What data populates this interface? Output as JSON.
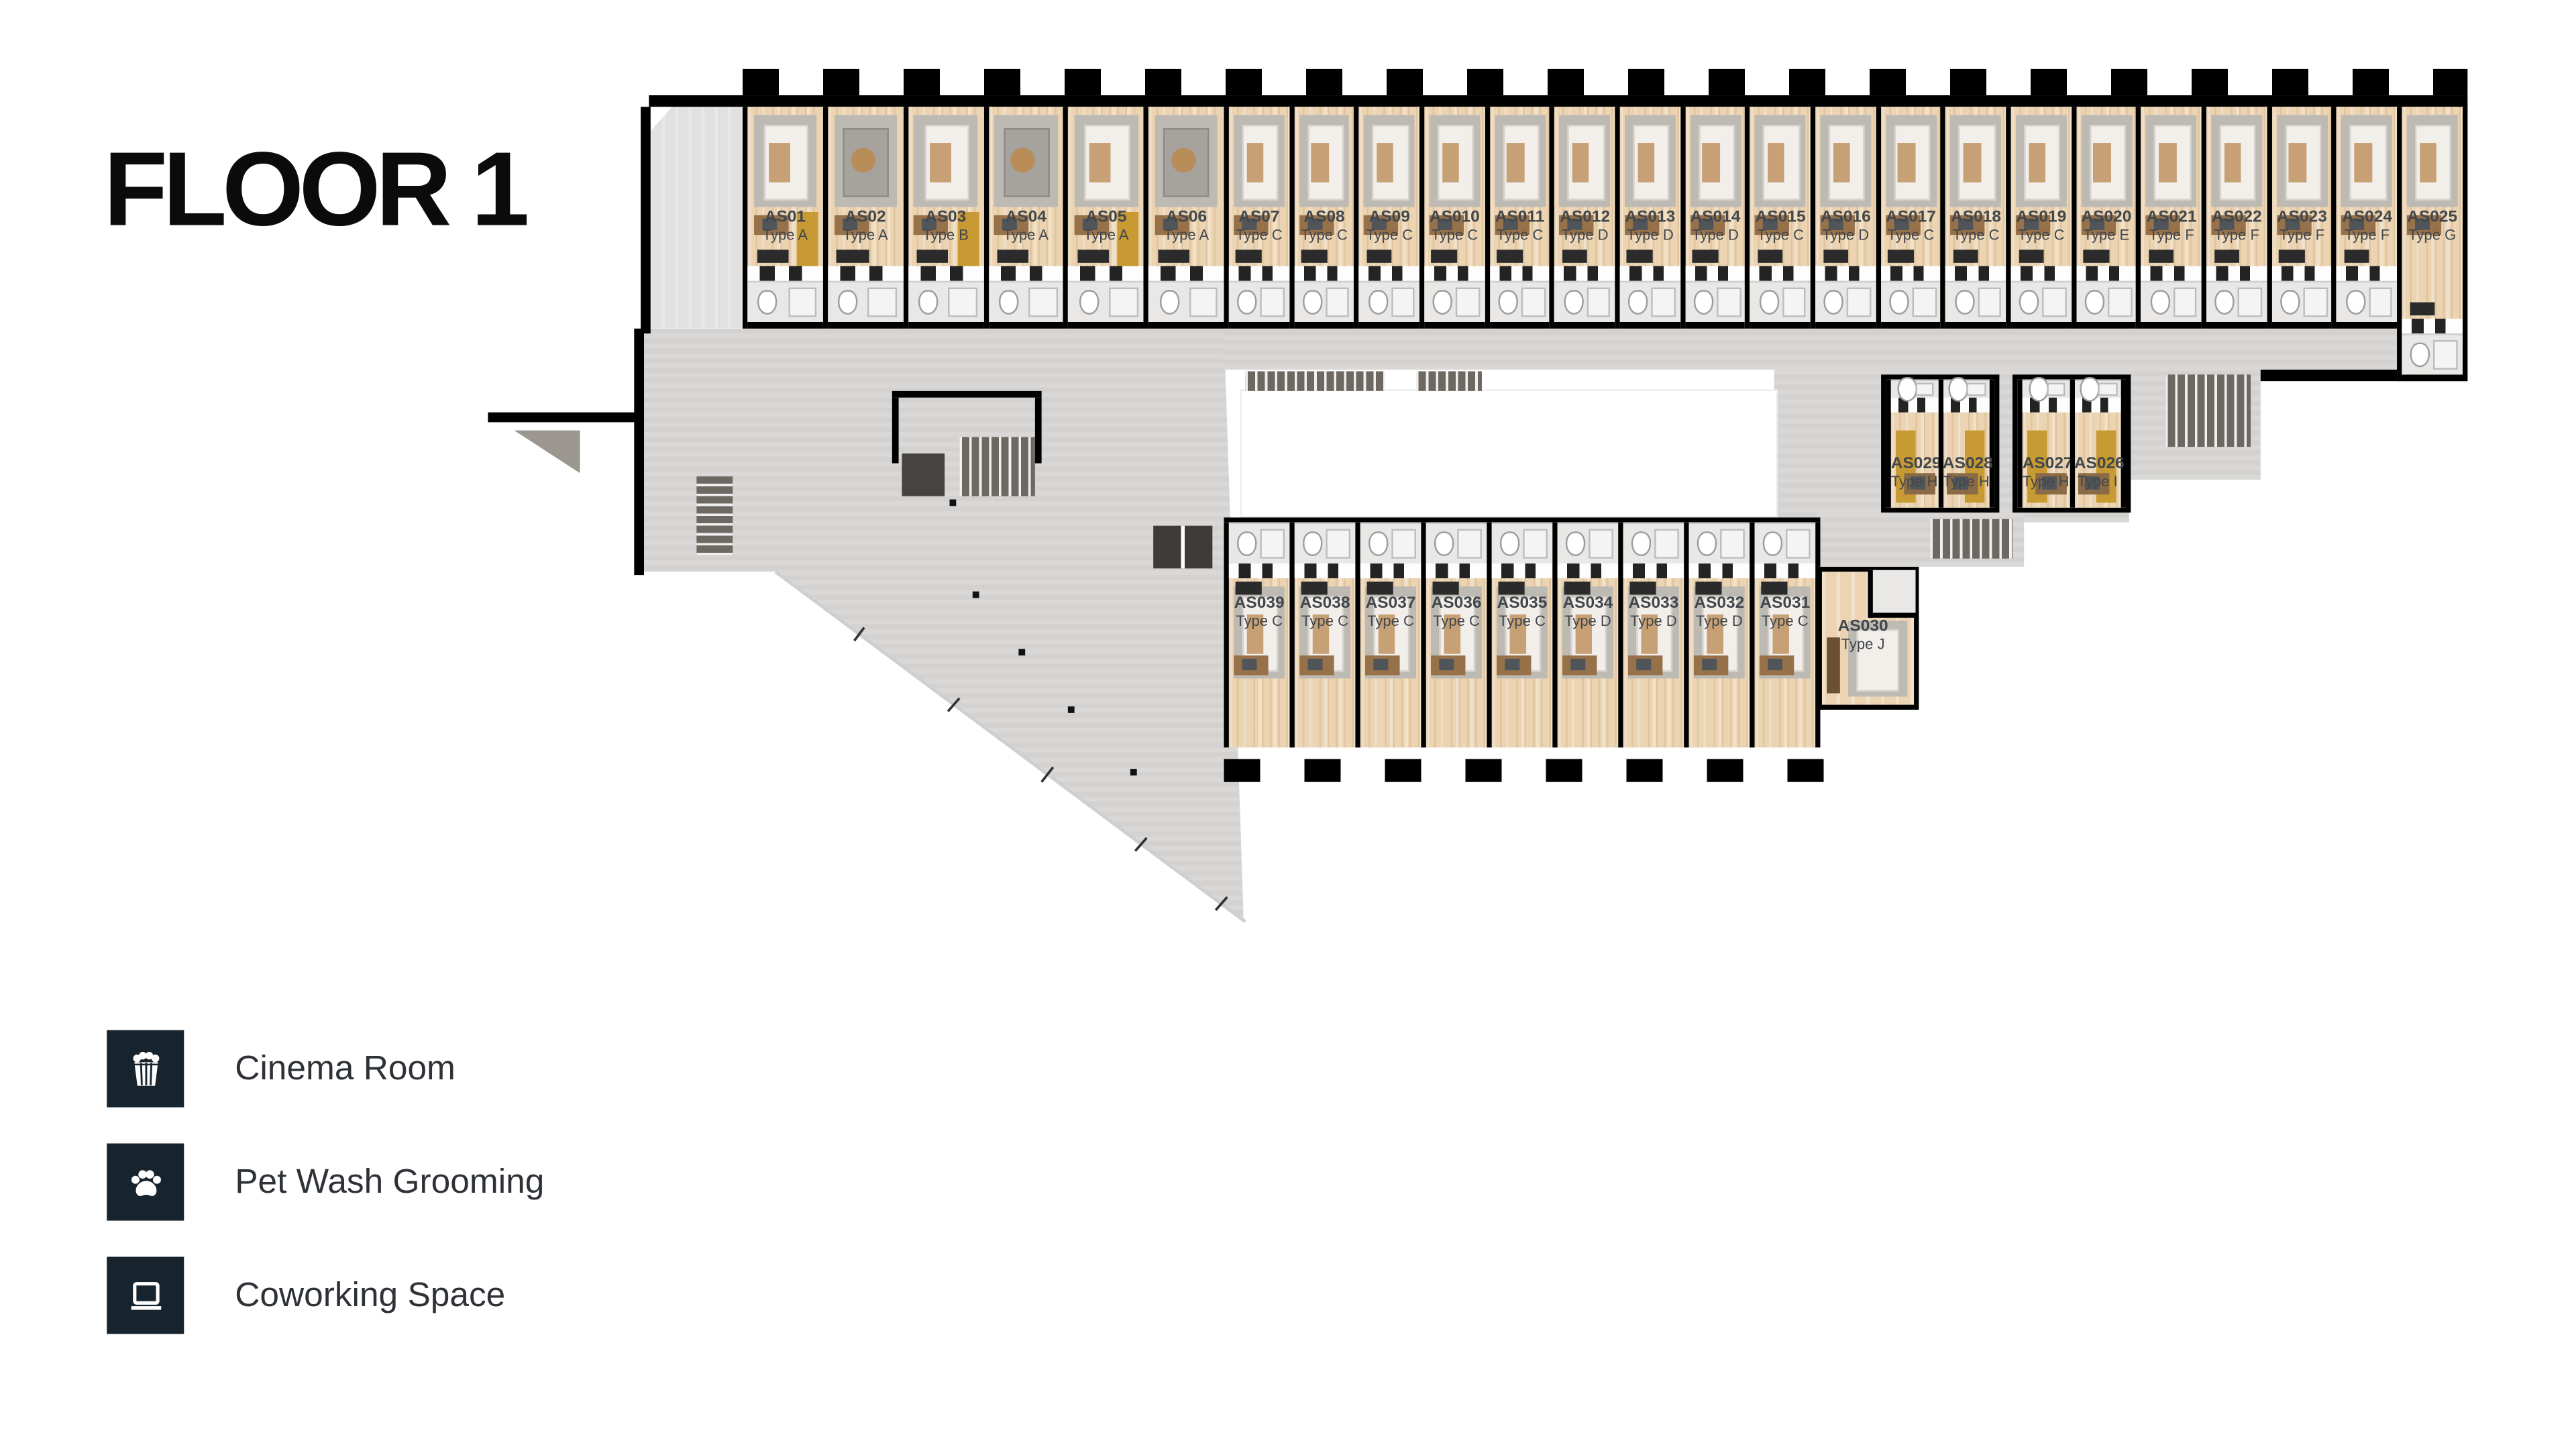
{
  "title": "FLOOR 1",
  "legend": [
    {
      "icon": "popcorn-icon",
      "label": "Cinema Room"
    },
    {
      "icon": "paw-icon",
      "label": "Pet Wash Grooming"
    },
    {
      "icon": "laptop-icon",
      "label": "Coworking Space"
    }
  ],
  "colors": {
    "legend_square": "#17242e",
    "wall": "#000000",
    "common_floor": "#d7d6d5",
    "unit_floor": "#ecd4b2",
    "stair": "#6e6862",
    "accent_sofa": "#c79a33",
    "label_text": "#42474c"
  },
  "plan": {
    "top_row": {
      "units": [
        {
          "id": "AS01",
          "type": "Type A",
          "wide": true,
          "furn": "bed"
        },
        {
          "id": "AS02",
          "type": "Type A",
          "wide": true,
          "furn": "sofa"
        },
        {
          "id": "AS03",
          "type": "Type B",
          "wide": true,
          "furn": "bed"
        },
        {
          "id": "AS04",
          "type": "Type A",
          "wide": true,
          "furn": "sofa"
        },
        {
          "id": "AS05",
          "type": "Type A",
          "wide": true,
          "furn": "bed"
        },
        {
          "id": "AS06",
          "type": "Type A",
          "wide": true,
          "furn": "sofa"
        },
        {
          "id": "AS07",
          "type": "Type C",
          "furn": "bed"
        },
        {
          "id": "AS08",
          "type": "Type C",
          "furn": "bed"
        },
        {
          "id": "AS09",
          "type": "Type C",
          "furn": "bed"
        },
        {
          "id": "AS010",
          "type": "Type C",
          "furn": "bed"
        },
        {
          "id": "AS011",
          "type": "Type C",
          "furn": "bed"
        },
        {
          "id": "AS012",
          "type": "Type D",
          "furn": "bed"
        },
        {
          "id": "AS013",
          "type": "Type D",
          "furn": "bed"
        },
        {
          "id": "AS014",
          "type": "Type D",
          "furn": "bed"
        },
        {
          "id": "AS015",
          "type": "Type C",
          "furn": "bed"
        },
        {
          "id": "AS016",
          "type": "Type D",
          "furn": "bed"
        },
        {
          "id": "AS017",
          "type": "Type C",
          "furn": "bed"
        },
        {
          "id": "AS018",
          "type": "Type C",
          "furn": "bed"
        },
        {
          "id": "AS019",
          "type": "Type C",
          "furn": "bed"
        },
        {
          "id": "AS020",
          "type": "Type E",
          "furn": "bed"
        },
        {
          "id": "AS021",
          "type": "Type F",
          "furn": "bed"
        },
        {
          "id": "AS022",
          "type": "Type F",
          "furn": "bed"
        },
        {
          "id": "AS023",
          "type": "Type F",
          "furn": "bed"
        },
        {
          "id": "AS024",
          "type": "Type F",
          "furn": "bed"
        },
        {
          "id": "AS025",
          "type": "Type G",
          "furn": "bed",
          "tall": true
        }
      ]
    },
    "mid_cluster": {
      "blocks": [
        [
          {
            "id": "AS029",
            "type": "Type H"
          },
          {
            "id": "AS028",
            "type": "Type H"
          }
        ],
        [
          {
            "id": "AS027",
            "type": "Type H"
          },
          {
            "id": "AS026",
            "type": "Type I"
          }
        ]
      ]
    },
    "bottom_row": {
      "units": [
        {
          "id": "AS039",
          "type": "Type C",
          "furn": "bed"
        },
        {
          "id": "AS038",
          "type": "Type C",
          "furn": "bed"
        },
        {
          "id": "AS037",
          "type": "Type C",
          "furn": "bed"
        },
        {
          "id": "AS036",
          "type": "Type C",
          "furn": "bed"
        },
        {
          "id": "AS035",
          "type": "Type C",
          "furn": "bed"
        },
        {
          "id": "AS034",
          "type": "Type D",
          "furn": "bed"
        },
        {
          "id": "AS033",
          "type": "Type D",
          "furn": "bed"
        },
        {
          "id": "AS032",
          "type": "Type D",
          "furn": "bed"
        },
        {
          "id": "AS031",
          "type": "Type C",
          "furn": "bed"
        }
      ]
    },
    "single_unit": {
      "id": "AS030",
      "type": "Type J"
    }
  }
}
